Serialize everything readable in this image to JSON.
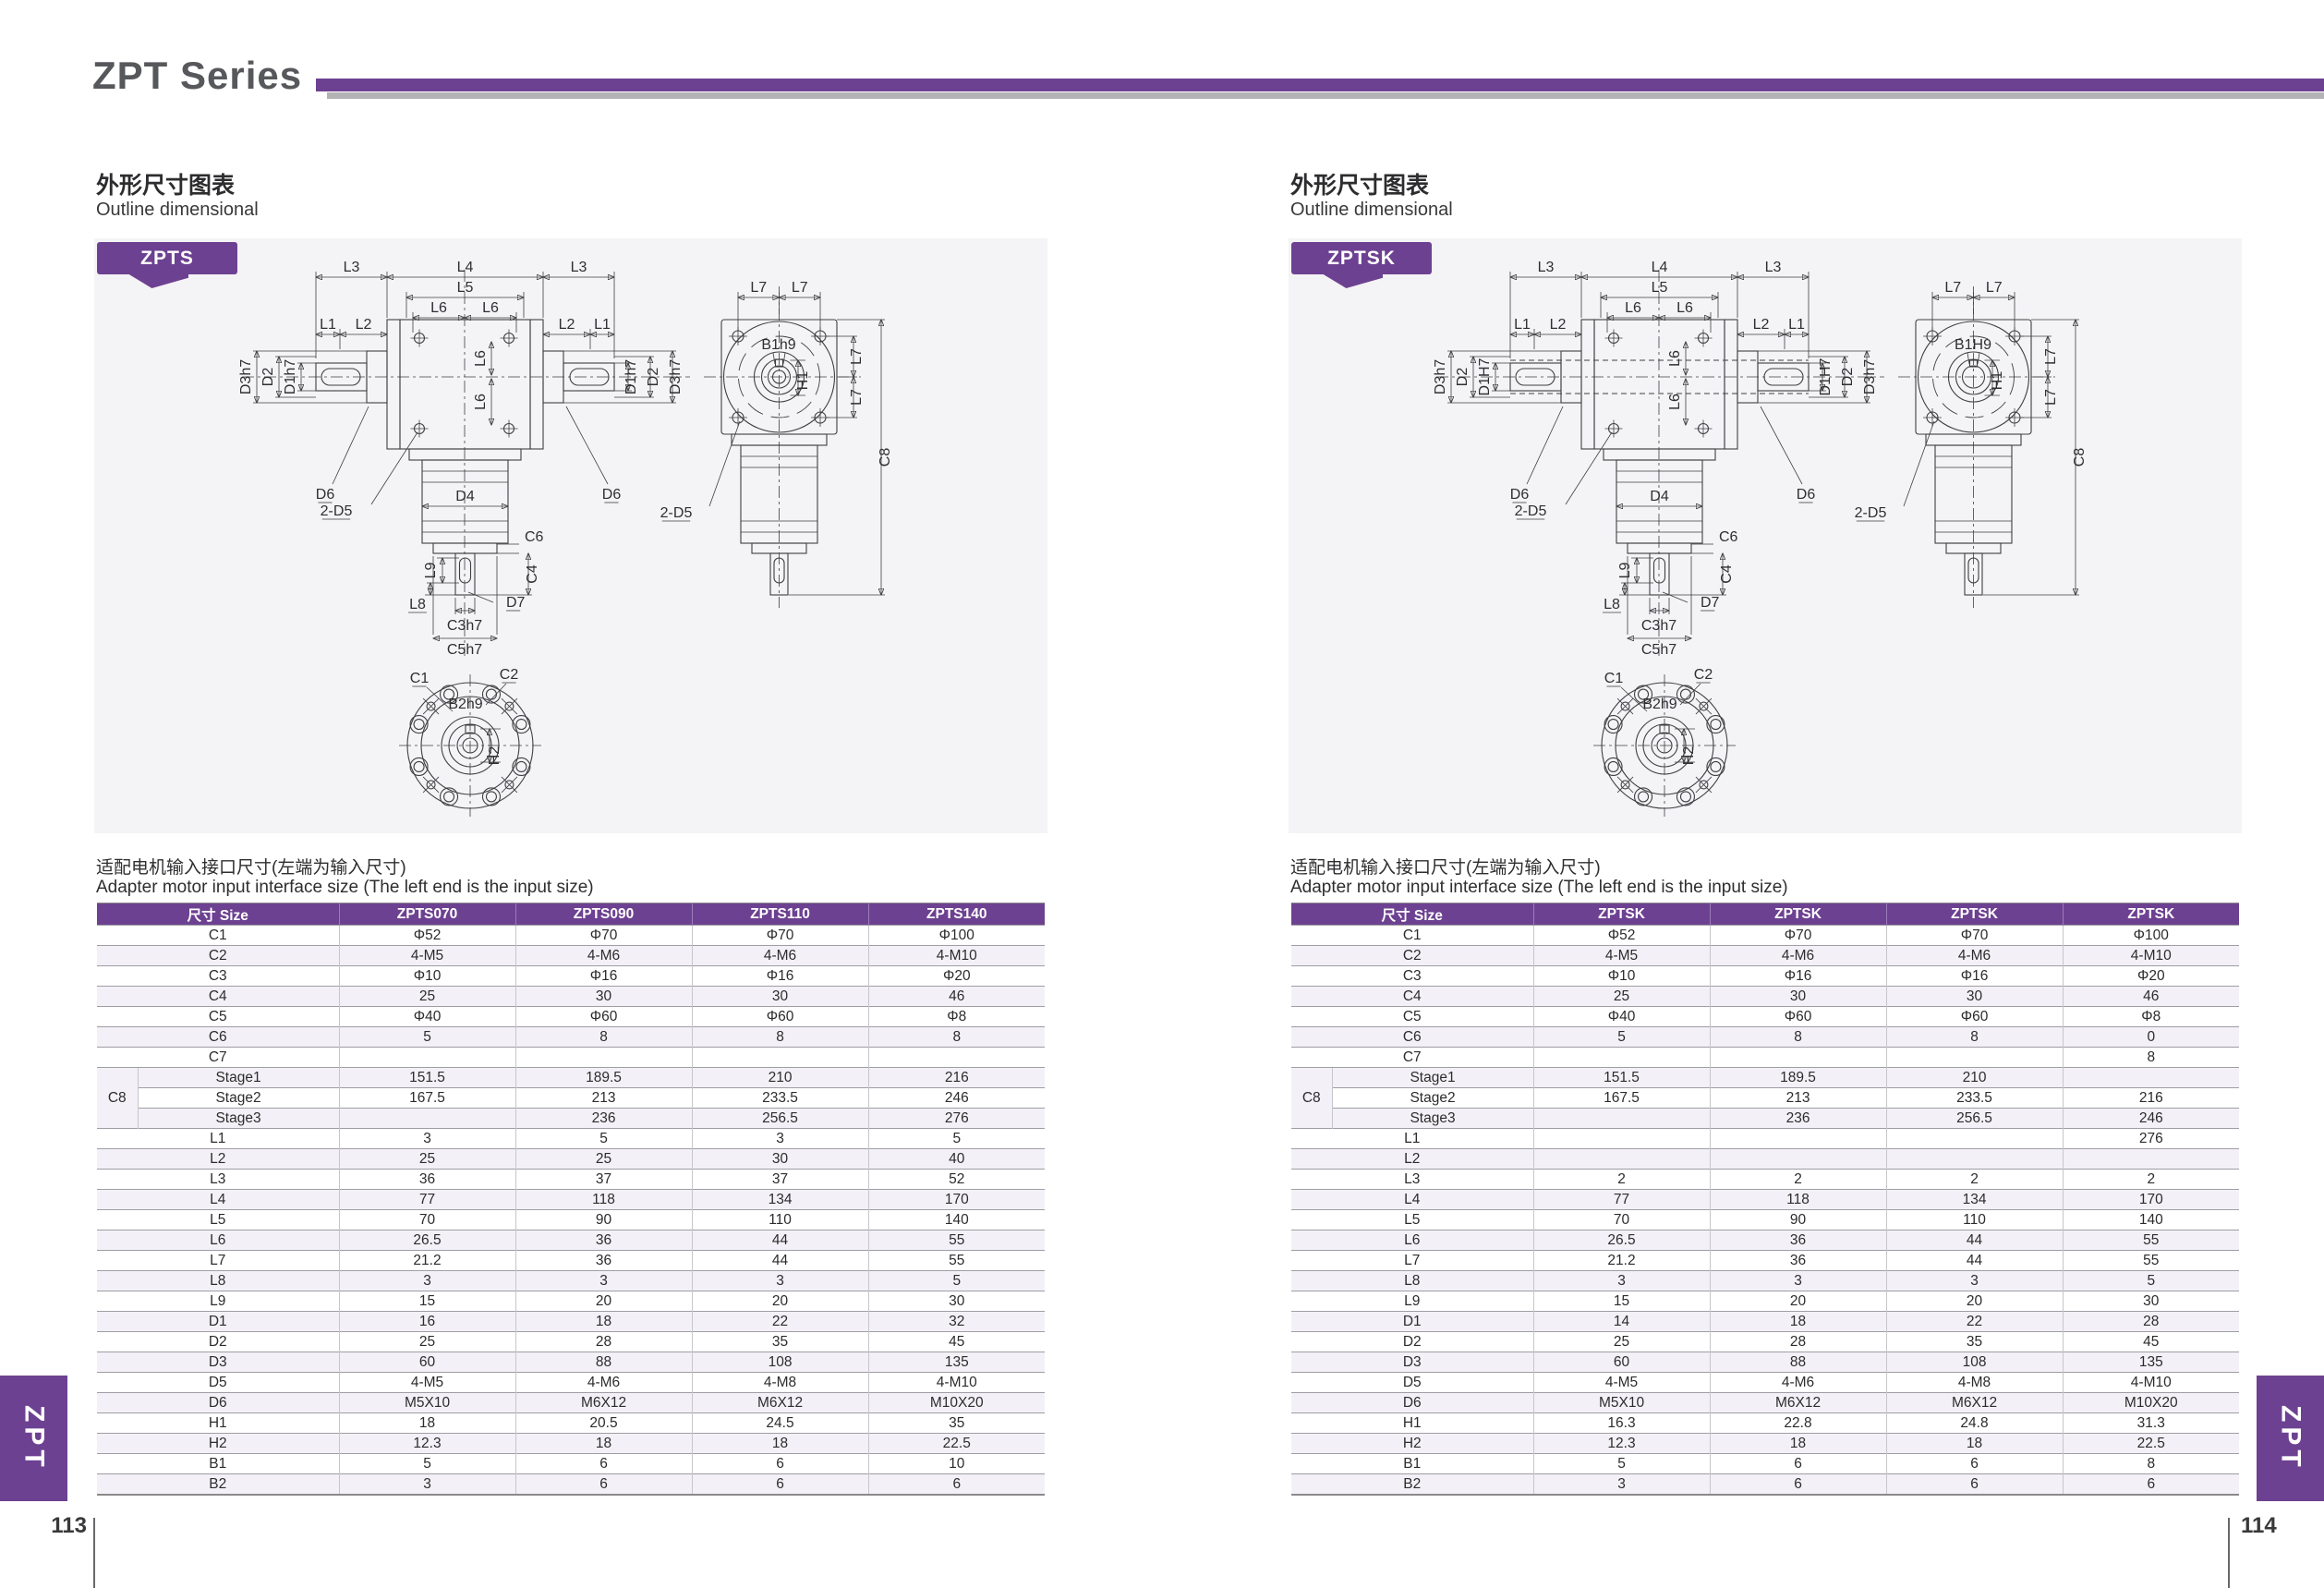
{
  "header": {
    "title": "ZPT Series"
  },
  "colors": {
    "accent": "#6d4191",
    "bar_gray": "#b3b3b6",
    "panel_bg": "#f4f3f6",
    "stripe": "#f3f1f7"
  },
  "side_tabs": {
    "left": "ZPT",
    "right": "ZPT"
  },
  "pages": [
    {
      "page_number": "113",
      "section_title_zh": "外形尺寸图表",
      "section_title_en": "Outline dimensional",
      "note_zh": "适配电机输入接口尺寸(左端为输入尺寸)",
      "note_en": "Adapter motor input interface size (The left end is the input size)",
      "drawing": {
        "tab": "ZPTS",
        "hollow": false,
        "labels": {
          "l1": "L1",
          "l2": "L2",
          "l3": "L3",
          "l4": "L4",
          "l5": "L5",
          "l6": "L6",
          "l7": "L7",
          "l8": "L8",
          "l9": "L9",
          "d1": "D1h7",
          "d2": "D2",
          "d3": "D3h7",
          "d4": "D4",
          "d5": "2-D5",
          "d6": "D6",
          "d7": "D7",
          "c1": "C1",
          "c2": "C2",
          "c3": "C3h7",
          "c4": "C4",
          "c5": "C5h7",
          "c6": "C6",
          "c8": "C8",
          "b1": "B1h9",
          "b2": "B2h9",
          "h1": "H1",
          "h2": "H2"
        }
      },
      "table": {
        "headers": [
          "尺寸 Size",
          "ZPTS070",
          "ZPTS090",
          "ZPTS110",
          "ZPTS140"
        ],
        "group_label": "C8",
        "rows": [
          {
            "label": "C1",
            "values": [
              "Φ52",
              "Φ70",
              "Φ70",
              "Φ100"
            ]
          },
          {
            "label": "C2",
            "values": [
              "4-M5",
              "4-M6",
              "4-M6",
              "4-M10"
            ]
          },
          {
            "label": "C3",
            "values": [
              "Φ10",
              "Φ16",
              "Φ16",
              "Φ20"
            ]
          },
          {
            "label": "C4",
            "values": [
              "25",
              "30",
              "30",
              "46"
            ]
          },
          {
            "label": "C5",
            "values": [
              "Φ40",
              "Φ60",
              "Φ60",
              "Φ8"
            ]
          },
          {
            "label": "C6",
            "values": [
              "5",
              "8",
              "8",
              "8"
            ]
          },
          {
            "label": "C7",
            "values": [
              "",
              "",
              "",
              ""
            ]
          },
          {
            "label": "Stage1",
            "group": true,
            "values": [
              "151.5",
              "189.5",
              "210",
              "216"
            ]
          },
          {
            "label": "Stage2",
            "group": true,
            "values": [
              "167.5",
              "213",
              "233.5",
              "246"
            ]
          },
          {
            "label": "Stage3",
            "group": true,
            "values": [
              "",
              "236",
              "256.5",
              "276"
            ]
          },
          {
            "label": "L1",
            "values": [
              "3",
              "5",
              "3",
              "5"
            ]
          },
          {
            "label": "L2",
            "values": [
              "25",
              "25",
              "30",
              "40"
            ]
          },
          {
            "label": "L3",
            "values": [
              "36",
              "37",
              "37",
              "52"
            ]
          },
          {
            "label": "L4",
            "values": [
              "77",
              "118",
              "134",
              "170"
            ]
          },
          {
            "label": "L5",
            "values": [
              "70",
              "90",
              "110",
              "140"
            ]
          },
          {
            "label": "L6",
            "values": [
              "26.5",
              "36",
              "44",
              "55"
            ]
          },
          {
            "label": "L7",
            "values": [
              "21.2",
              "36",
              "44",
              "55"
            ]
          },
          {
            "label": "L8",
            "values": [
              "3",
              "3",
              "3",
              "5"
            ]
          },
          {
            "label": "L9",
            "values": [
              "15",
              "20",
              "20",
              "30"
            ]
          },
          {
            "label": "D1",
            "values": [
              "16",
              "18",
              "22",
              "32"
            ]
          },
          {
            "label": "D2",
            "values": [
              "25",
              "28",
              "35",
              "45"
            ]
          },
          {
            "label": "D3",
            "values": [
              "60",
              "88",
              "108",
              "135"
            ]
          },
          {
            "label": "D5",
            "values": [
              "4-M5",
              "4-M6",
              "4-M8",
              "4-M10"
            ]
          },
          {
            "label": "D6",
            "values": [
              "M5X10",
              "M6X12",
              "M6X12",
              "M10X20"
            ]
          },
          {
            "label": "H1",
            "values": [
              "18",
              "20.5",
              "24.5",
              "35"
            ]
          },
          {
            "label": "H2",
            "values": [
              "12.3",
              "18",
              "18",
              "22.5"
            ]
          },
          {
            "label": "B1",
            "values": [
              "5",
              "6",
              "6",
              "10"
            ]
          },
          {
            "label": "B2",
            "values": [
              "3",
              "6",
              "6",
              "6"
            ]
          }
        ]
      }
    },
    {
      "page_number": "114",
      "section_title_zh": "外形尺寸图表",
      "section_title_en": "Outline dimensional",
      "note_zh": "适配电机输入接口尺寸(左端为输入尺寸)",
      "note_en": "Adapter motor input interface size (The left end is the input size)",
      "drawing": {
        "tab": "ZPTSK",
        "hollow": true,
        "labels": {
          "l1": "L1",
          "l2": "L2",
          "l3": "L3",
          "l4": "L4",
          "l5": "L5",
          "l6": "L6",
          "l7": "L7",
          "l8": "L8",
          "l9": "L9",
          "d1": "D1H7",
          "d2": "D2",
          "d3": "D3h7",
          "d4": "D4",
          "d5": "2-D5",
          "d6": "D6",
          "d7": "D7",
          "c1": "C1",
          "c2": "C2",
          "c3": "C3h7",
          "c4": "C4",
          "c5": "C5h7",
          "c6": "C6",
          "c8": "C8",
          "b1": "B1H9",
          "b2": "B2h9",
          "h1": "H1",
          "h2": "H2"
        }
      },
      "table": {
        "headers": [
          "尺寸 Size",
          "ZPTSK",
          "ZPTSK",
          "ZPTSK",
          "ZPTSK"
        ],
        "group_label": "C8",
        "rows": [
          {
            "label": "C1",
            "values": [
              "Φ52",
              "Φ70",
              "Φ70",
              "Φ100"
            ]
          },
          {
            "label": "C2",
            "values": [
              "4-M5",
              "4-M6",
              "4-M6",
              "4-M10"
            ]
          },
          {
            "label": "C3",
            "values": [
              "Φ10",
              "Φ16",
              "Φ16",
              "Φ20"
            ]
          },
          {
            "label": "C4",
            "values": [
              "25",
              "30",
              "30",
              "46"
            ]
          },
          {
            "label": "C5",
            "values": [
              "Φ40",
              "Φ60",
              "Φ60",
              "Φ8"
            ]
          },
          {
            "label": "C6",
            "values": [
              "5",
              "8",
              "8",
              "0"
            ]
          },
          {
            "label": "C7",
            "values": [
              "",
              "",
              "",
              "8"
            ]
          },
          {
            "label": "Stage1",
            "group": true,
            "values": [
              "151.5",
              "189.5",
              "210",
              ""
            ]
          },
          {
            "label": "Stage2",
            "group": true,
            "values": [
              "167.5",
              "213",
              "233.5",
              "216"
            ]
          },
          {
            "label": "Stage3",
            "group": true,
            "values": [
              "",
              "236",
              "256.5",
              "246"
            ]
          },
          {
            "label": "L1",
            "values": [
              "",
              "",
              "",
              "276"
            ]
          },
          {
            "label": "L2",
            "values": [
              "",
              "",
              "",
              ""
            ]
          },
          {
            "label": "L3",
            "values": [
              "2",
              "2",
              "2",
              "2"
            ]
          },
          {
            "label": "L4",
            "values": [
              "77",
              "118",
              "134",
              "170"
            ]
          },
          {
            "label": "L5",
            "values": [
              "70",
              "90",
              "110",
              "140"
            ]
          },
          {
            "label": "L6",
            "values": [
              "26.5",
              "36",
              "44",
              "55"
            ]
          },
          {
            "label": "L7",
            "values": [
              "21.2",
              "36",
              "44",
              "55"
            ]
          },
          {
            "label": "L8",
            "values": [
              "3",
              "3",
              "3",
              "5"
            ]
          },
          {
            "label": "L9",
            "values": [
              "15",
              "20",
              "20",
              "30"
            ]
          },
          {
            "label": "D1",
            "values": [
              "14",
              "18",
              "22",
              "28"
            ]
          },
          {
            "label": "D2",
            "values": [
              "25",
              "28",
              "35",
              "45"
            ]
          },
          {
            "label": "D3",
            "values": [
              "60",
              "88",
              "108",
              "135"
            ]
          },
          {
            "label": "D5",
            "values": [
              "4-M5",
              "4-M6",
              "4-M8",
              "4-M10"
            ]
          },
          {
            "label": "D6",
            "values": [
              "M5X10",
              "M6X12",
              "M6X12",
              "M10X20"
            ]
          },
          {
            "label": "H1",
            "values": [
              "16.3",
              "22.8",
              "24.8",
              "31.3"
            ]
          },
          {
            "label": "H2",
            "values": [
              "12.3",
              "18",
              "18",
              "22.5"
            ]
          },
          {
            "label": "B1",
            "values": [
              "5",
              "6",
              "6",
              "8"
            ]
          },
          {
            "label": "B2",
            "values": [
              "3",
              "6",
              "6",
              "6"
            ]
          }
        ]
      }
    }
  ]
}
